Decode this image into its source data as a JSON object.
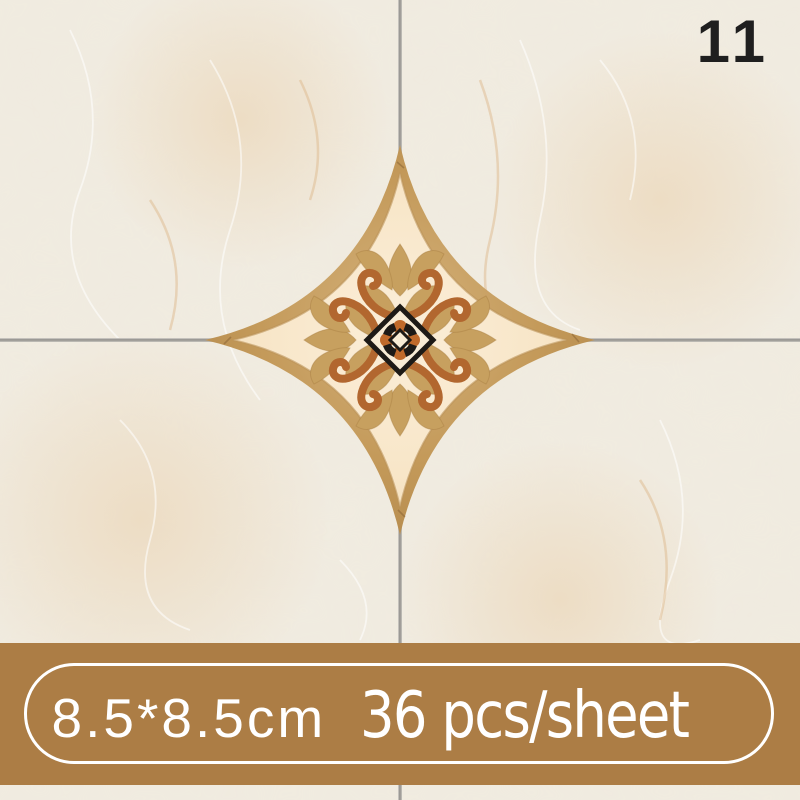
{
  "product_image": {
    "badge_number": "11",
    "spec_banner": {
      "size_label": "8.5*8.5cm",
      "count_label": "36 pcs/sheet"
    },
    "decal": {
      "shape": "four-point-star",
      "motifs": [
        "lotus-flower",
        "scroll-ornament",
        "center-medallion"
      ]
    },
    "colors": {
      "marble_base": "#f0ebe0",
      "grout_line": "#8f8d89",
      "badge_text": "#1f1f1f",
      "banner_background": "#ac7d45",
      "banner_text": "#ffffff",
      "decal_border_tan": "#c49a5a",
      "decal_field_peach": "#f8e6c8",
      "decal_flower_tan": "#c7a05f",
      "decal_scroll_terracotta": "#b2672f",
      "decal_medallion_black": "#1d1a16",
      "decal_medallion_orange": "#c06a2a"
    }
  }
}
